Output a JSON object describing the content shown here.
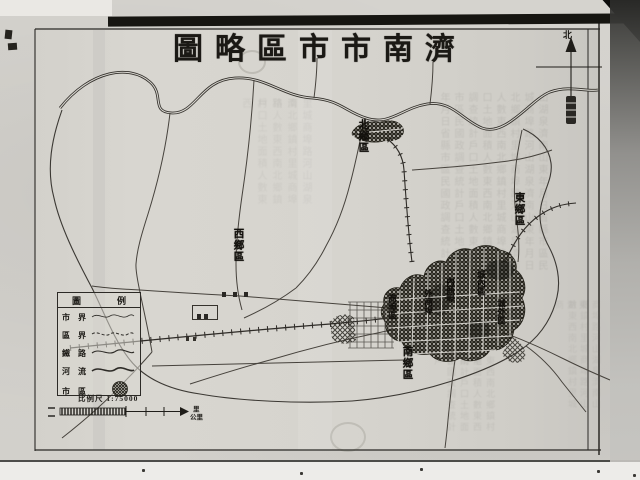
{
  "colors": {
    "paper": "#d7d5cf",
    "ink": "#201e1a",
    "photo_bg": "#cfcdc9"
  },
  "title": {
    "display": "圖略區市市南濟",
    "reading_rtl": "濟南市市區略圖"
  },
  "north_arrow": {
    "label": "北"
  },
  "legend": {
    "header_left": "圖",
    "header_right": "例",
    "rows": [
      {
        "label": "市界",
        "symbol": "wavy-line-thin"
      },
      {
        "label": "區界",
        "symbol": "wavy-line-dotted"
      },
      {
        "label": "鐵路",
        "symbol": "wavy-line"
      },
      {
        "label": "河流",
        "symbol": "wavy-line-thick"
      },
      {
        "label": "市區",
        "symbol": "hatched-circle"
      }
    ]
  },
  "scale": {
    "label": "比例尺",
    "ratio": "1:75000",
    "unit_top": "里",
    "unit_bottom": "公里"
  },
  "map": {
    "district_labels": [
      {
        "text": "北鄉區",
        "x": 357,
        "y": 119
      },
      {
        "text": "東鄉區",
        "x": 513,
        "y": 192
      },
      {
        "text": "西鄉區",
        "x": 232,
        "y": 228
      },
      {
        "text": "南鄉區",
        "x": 401,
        "y": 346
      }
    ],
    "city_labels": [
      {
        "text": "商埠區",
        "x": 388,
        "y": 294
      },
      {
        "text": "外商埠",
        "x": 424,
        "y": 289
      },
      {
        "text": "內商埠",
        "x": 446,
        "y": 277
      },
      {
        "text": "城內區",
        "x": 477,
        "y": 270
      },
      {
        "text": "城外區",
        "x": 497,
        "y": 299
      }
    ],
    "small_marks": [
      {
        "type": "three-char-label",
        "x": 222,
        "y": 284
      },
      {
        "type": "boxed-label",
        "x": 192,
        "y": 305
      },
      {
        "type": "two-dot-label",
        "x": 186,
        "y": 328
      }
    ]
  }
}
